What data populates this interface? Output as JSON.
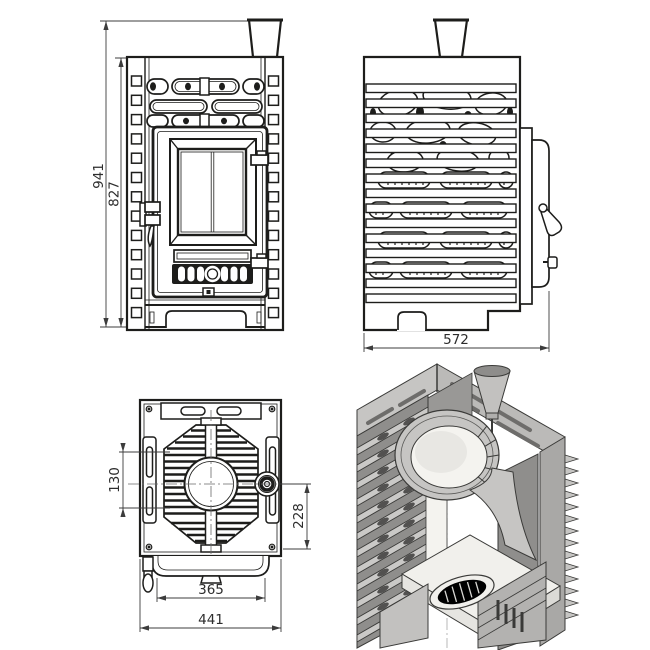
{
  "drawing": {
    "title": "sauna-stove-technical-drawing",
    "background_color": "#ffffff",
    "line_color": "#1d1d1b",
    "dimension_color": "#3c3c3c",
    "metal_gray": "#c6c5c3",
    "front_view": {
      "overall_height_mm": "941",
      "body_height_mm": "827"
    },
    "side_view": {
      "depth_mm": "572"
    },
    "top_view": {
      "stone_opening_offset_mm": "130",
      "flue_collar_offset_mm": "228",
      "door_assembly_width_mm": "365",
      "overall_width_mm": "441"
    },
    "cutaway_view": {}
  }
}
